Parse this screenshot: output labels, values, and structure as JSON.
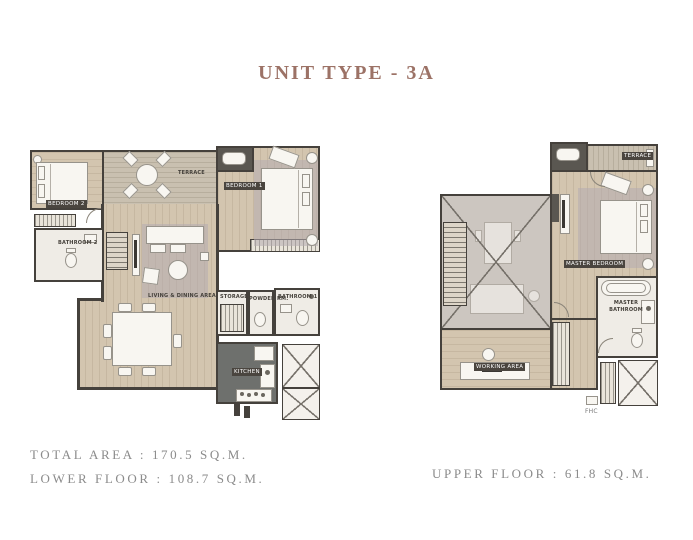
{
  "title": "UNIT TYPE - 3A",
  "summary": {
    "total_area": "TOTAL AREA : 170.5 SQ.M.",
    "lower_floor": "LOWER FLOOR : 108.7 SQ.M.",
    "upper_floor": "UPPER FLOOR : 61.8 SQ.M."
  },
  "lower_floor": {
    "labels": {
      "bedroom2": "BEDROOM 2",
      "terrace": "TERRACE",
      "bedroom1": "BEDROOM 1",
      "bathroom2": "BATHROOM 2",
      "living_dining": "LIVING & DINING AREA",
      "storage": "STORAGE",
      "powder": "POWDER RM.",
      "bathroom1": "BATHROOM 1",
      "kitchen": "KITCHEN"
    }
  },
  "upper_floor": {
    "labels": {
      "terrace": "TERRACE",
      "master_bedroom": "MASTER BEDROOM",
      "master_bathroom": "MASTER BATHROOM",
      "working_area": "WORKING AREA",
      "fhc": "FHC"
    }
  },
  "colors": {
    "title_text": "#9c7266",
    "summary_text": "#8b8b8b",
    "wall": "#45413c",
    "wood_floor": "#d3c5af",
    "terrace_deck": "#c9c0b0",
    "kitchen_floor": "#6e706d",
    "void_fill": "#ccc6c0",
    "label_badge": "#4a453f",
    "furniture": "#f8f6f1"
  }
}
